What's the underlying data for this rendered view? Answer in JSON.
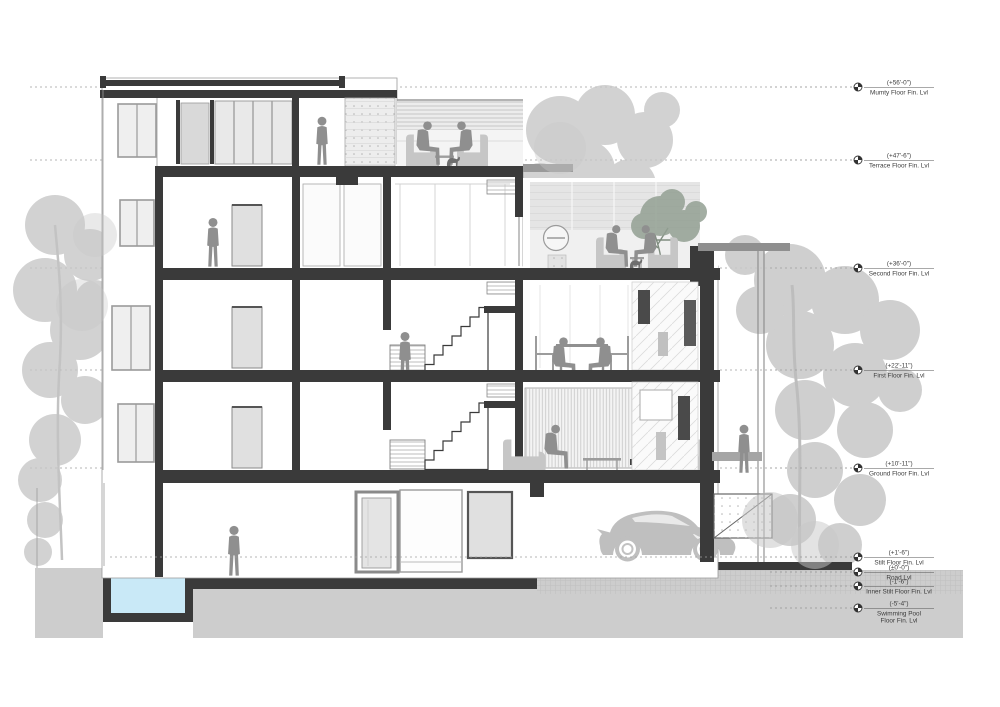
{
  "drawing": {
    "type": "architectural-building-section",
    "levels": [
      {
        "id": "mumty",
        "elevation": "(+56'-0\")",
        "label": "Mumty Floor Fin. Lvl",
        "y": 87,
        "full_line": true
      },
      {
        "id": "terrace",
        "elevation": "(+47'-6\")",
        "label": "Terrace Floor Fin. Lvl",
        "y": 160,
        "full_line": true
      },
      {
        "id": "second",
        "elevation": "(+36'-0\")",
        "label": "Second Floor Fin. Lvl",
        "y": 268,
        "full_line": true
      },
      {
        "id": "first",
        "elevation": "(+22'-11\")",
        "label": "First Floor Fin. Lvl",
        "y": 370,
        "full_line": true
      },
      {
        "id": "ground",
        "elevation": "(+10'-11\")",
        "label": "Ground Floor Fin. Lvl",
        "y": 468,
        "full_line": true
      },
      {
        "id": "stilt",
        "elevation": "(+1'-6\")",
        "label": "Stilt Floor Fin. Lvl",
        "y": 557,
        "full_line": false
      },
      {
        "id": "road",
        "elevation": "(±0'-0\")",
        "label": "Road Lvl",
        "y": 572,
        "full_line": false
      },
      {
        "id": "inner-stilt",
        "elevation": "(-1'-6\")",
        "label": "Inner Stilt Floor Fin. Lvl",
        "y": 586,
        "full_line": false
      },
      {
        "id": "pool",
        "elevation": "(-5'-4\")",
        "label": "Swimming Pool",
        "label2": "Floor Fin. Lvl",
        "y": 608,
        "full_line": false
      }
    ],
    "scene_icons": [
      "building-section",
      "swimming-pool",
      "car-silhouette",
      "tree-silhouette",
      "person-silhouette",
      "dog-silhouette",
      "staircase",
      "level-marker-icon"
    ],
    "colors": {
      "cut_structure": "#3a3a3a",
      "ground": "#cdcdcd",
      "pool_water": "#c9e9f7",
      "people": "#8f8f8f",
      "furniture": "#c6c6c6",
      "tree_foliage": "#c7c7c7",
      "terrace_tree": "#93a093",
      "canopy": "#8f8f8f",
      "line_work": "#9a9a9a"
    }
  }
}
